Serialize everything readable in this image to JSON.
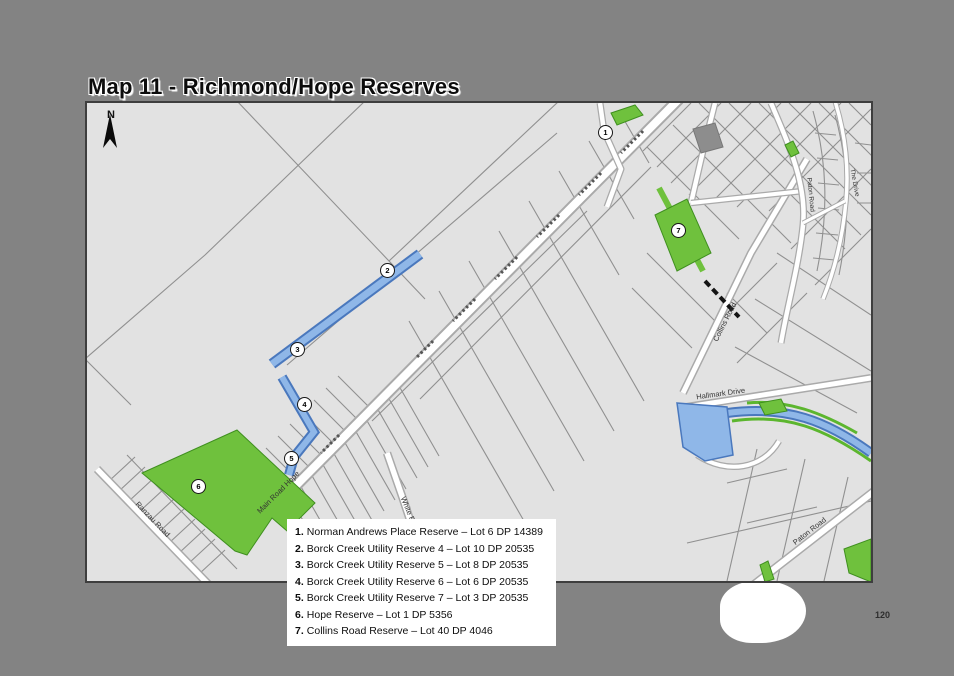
{
  "page": {
    "title": "Map 11 - Richmond/Hope Reserves",
    "page_number": "120"
  },
  "map": {
    "north_label": "N",
    "labels": {
      "main_road_hope": "Main Road Hope",
      "white_road": "White Road",
      "ranzau_road": "Ranzau Road",
      "collins_road": "Collins Road",
      "hallmark_drive": "Hallmark Drive",
      "paton_road": "Paton Road",
      "the_drive": "The Drive"
    },
    "markers": [
      {
        "n": "1"
      },
      {
        "n": "2"
      },
      {
        "n": "3"
      },
      {
        "n": "4"
      },
      {
        "n": "5"
      },
      {
        "n": "6"
      },
      {
        "n": "7"
      }
    ],
    "colors": {
      "reserve_green": "#6fc13d",
      "water_fill": "#8fb7e8",
      "water_edge": "#4a78bd",
      "map_background": "#e2e2e2",
      "road_fill": "#ffffff"
    }
  },
  "legend": {
    "items": [
      {
        "num": "1.",
        "text": "Norman Andrews Place Reserve – Lot 6 DP 14389"
      },
      {
        "num": "2.",
        "text": "Borck Creek Utility Reserve 4 – Lot 10 DP 20535"
      },
      {
        "num": "3.",
        "text": "Borck Creek Utility Reserve 5 – Lot 8 DP 20535"
      },
      {
        "num": "4.",
        "text": "Borck Creek Utility Reserve 6 – Lot 6 DP 20535"
      },
      {
        "num": "5.",
        "text": "Borck Creek Utility Reserve 7 – Lot 3 DP 20535"
      },
      {
        "num": "6.",
        "text": "Hope Reserve – Lot 1 DP 5356"
      },
      {
        "num": "7.",
        "text": "Collins Road Reserve – Lot 40 DP 4046"
      }
    ]
  }
}
